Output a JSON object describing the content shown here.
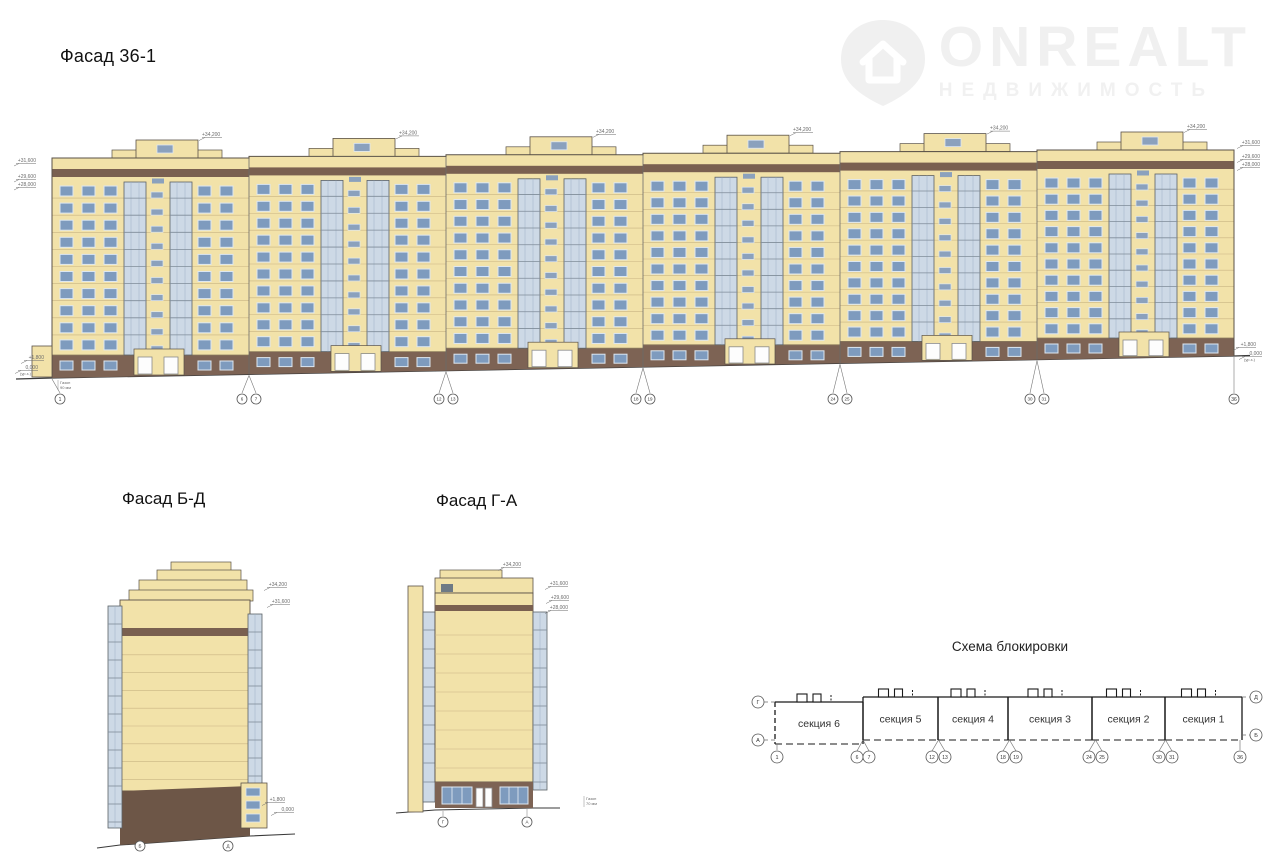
{
  "titles": {
    "main": "Фасад 36-1",
    "side_bd": "Фасад Б-Д",
    "side_ga": "Фасад Г-А",
    "scheme": "Схема блокировки"
  },
  "watermark": {
    "brand": "ONREALT",
    "subtitle": "НЕДВИЖИМОСТЬ",
    "color": "#f0f0f0"
  },
  "main_facade": {
    "top_elevation": "+34,200",
    "left_elevations": [
      "+31,600",
      "+29,600",
      "+28,000"
    ],
    "right_elevations": [
      "+31,600",
      "+29,600",
      "+28,000"
    ],
    "bottom_left_elevations": [
      "+1,800",
      "0,000",
      "(ур.з.)"
    ],
    "bottom_right_elevations": [
      "+1,800",
      "0,000",
      "(ур.з.)"
    ],
    "ground_note": [
      "Газон",
      "90 мм"
    ],
    "axis_groups": [
      [
        "1"
      ],
      [
        "6",
        "7"
      ],
      [
        "12",
        "13"
      ],
      [
        "18",
        "19"
      ],
      [
        "24",
        "25"
      ],
      [
        "30",
        "31"
      ],
      [
        "36"
      ]
    ],
    "sections_count": 6,
    "floors_count": 10
  },
  "facade_bd": {
    "elevations": [
      "+34,200",
      "+31,600"
    ],
    "bottom_elevations": [
      "+1,800",
      "0,000"
    ],
    "axes": [
      "Б",
      "Д"
    ]
  },
  "facade_ga": {
    "elevations": [
      "+34,200",
      "+31,600",
      "+29,600",
      "+28,000"
    ],
    "axes": [
      "Г",
      "А"
    ],
    "ground_note": [
      "Газон",
      "70 мм"
    ]
  },
  "scheme": {
    "sections": [
      "секция 6",
      "секция 5",
      "секция 4",
      "секция 3",
      "секция 2",
      "секция 1"
    ],
    "left_axes": [
      "Г",
      "А"
    ],
    "right_axes": [
      "Д",
      "Б"
    ],
    "bottom_axes": [
      [
        "1"
      ],
      [
        "6",
        "7"
      ],
      [
        "12",
        "13"
      ],
      [
        "18",
        "19"
      ],
      [
        "24",
        "25"
      ],
      [
        "30",
        "31"
      ],
      [
        "36"
      ]
    ]
  },
  "colors": {
    "wall": "#f2e2a9",
    "wall_line": "#c9b483",
    "outline": "#5a5248",
    "band": "#7a6050",
    "plinth": "#7d6354",
    "glass": "#7e9bbe",
    "glass_frame": "#dde7f0",
    "balcony": "#cdd9e6",
    "balcony_line": "#9db0c5",
    "balcony_frame": "#5b6166",
    "stair_win": "#8ba1bd",
    "ground": "#3a3a3a",
    "dim": "#6b6b6b",
    "scheme_line": "#1a1a1a"
  }
}
